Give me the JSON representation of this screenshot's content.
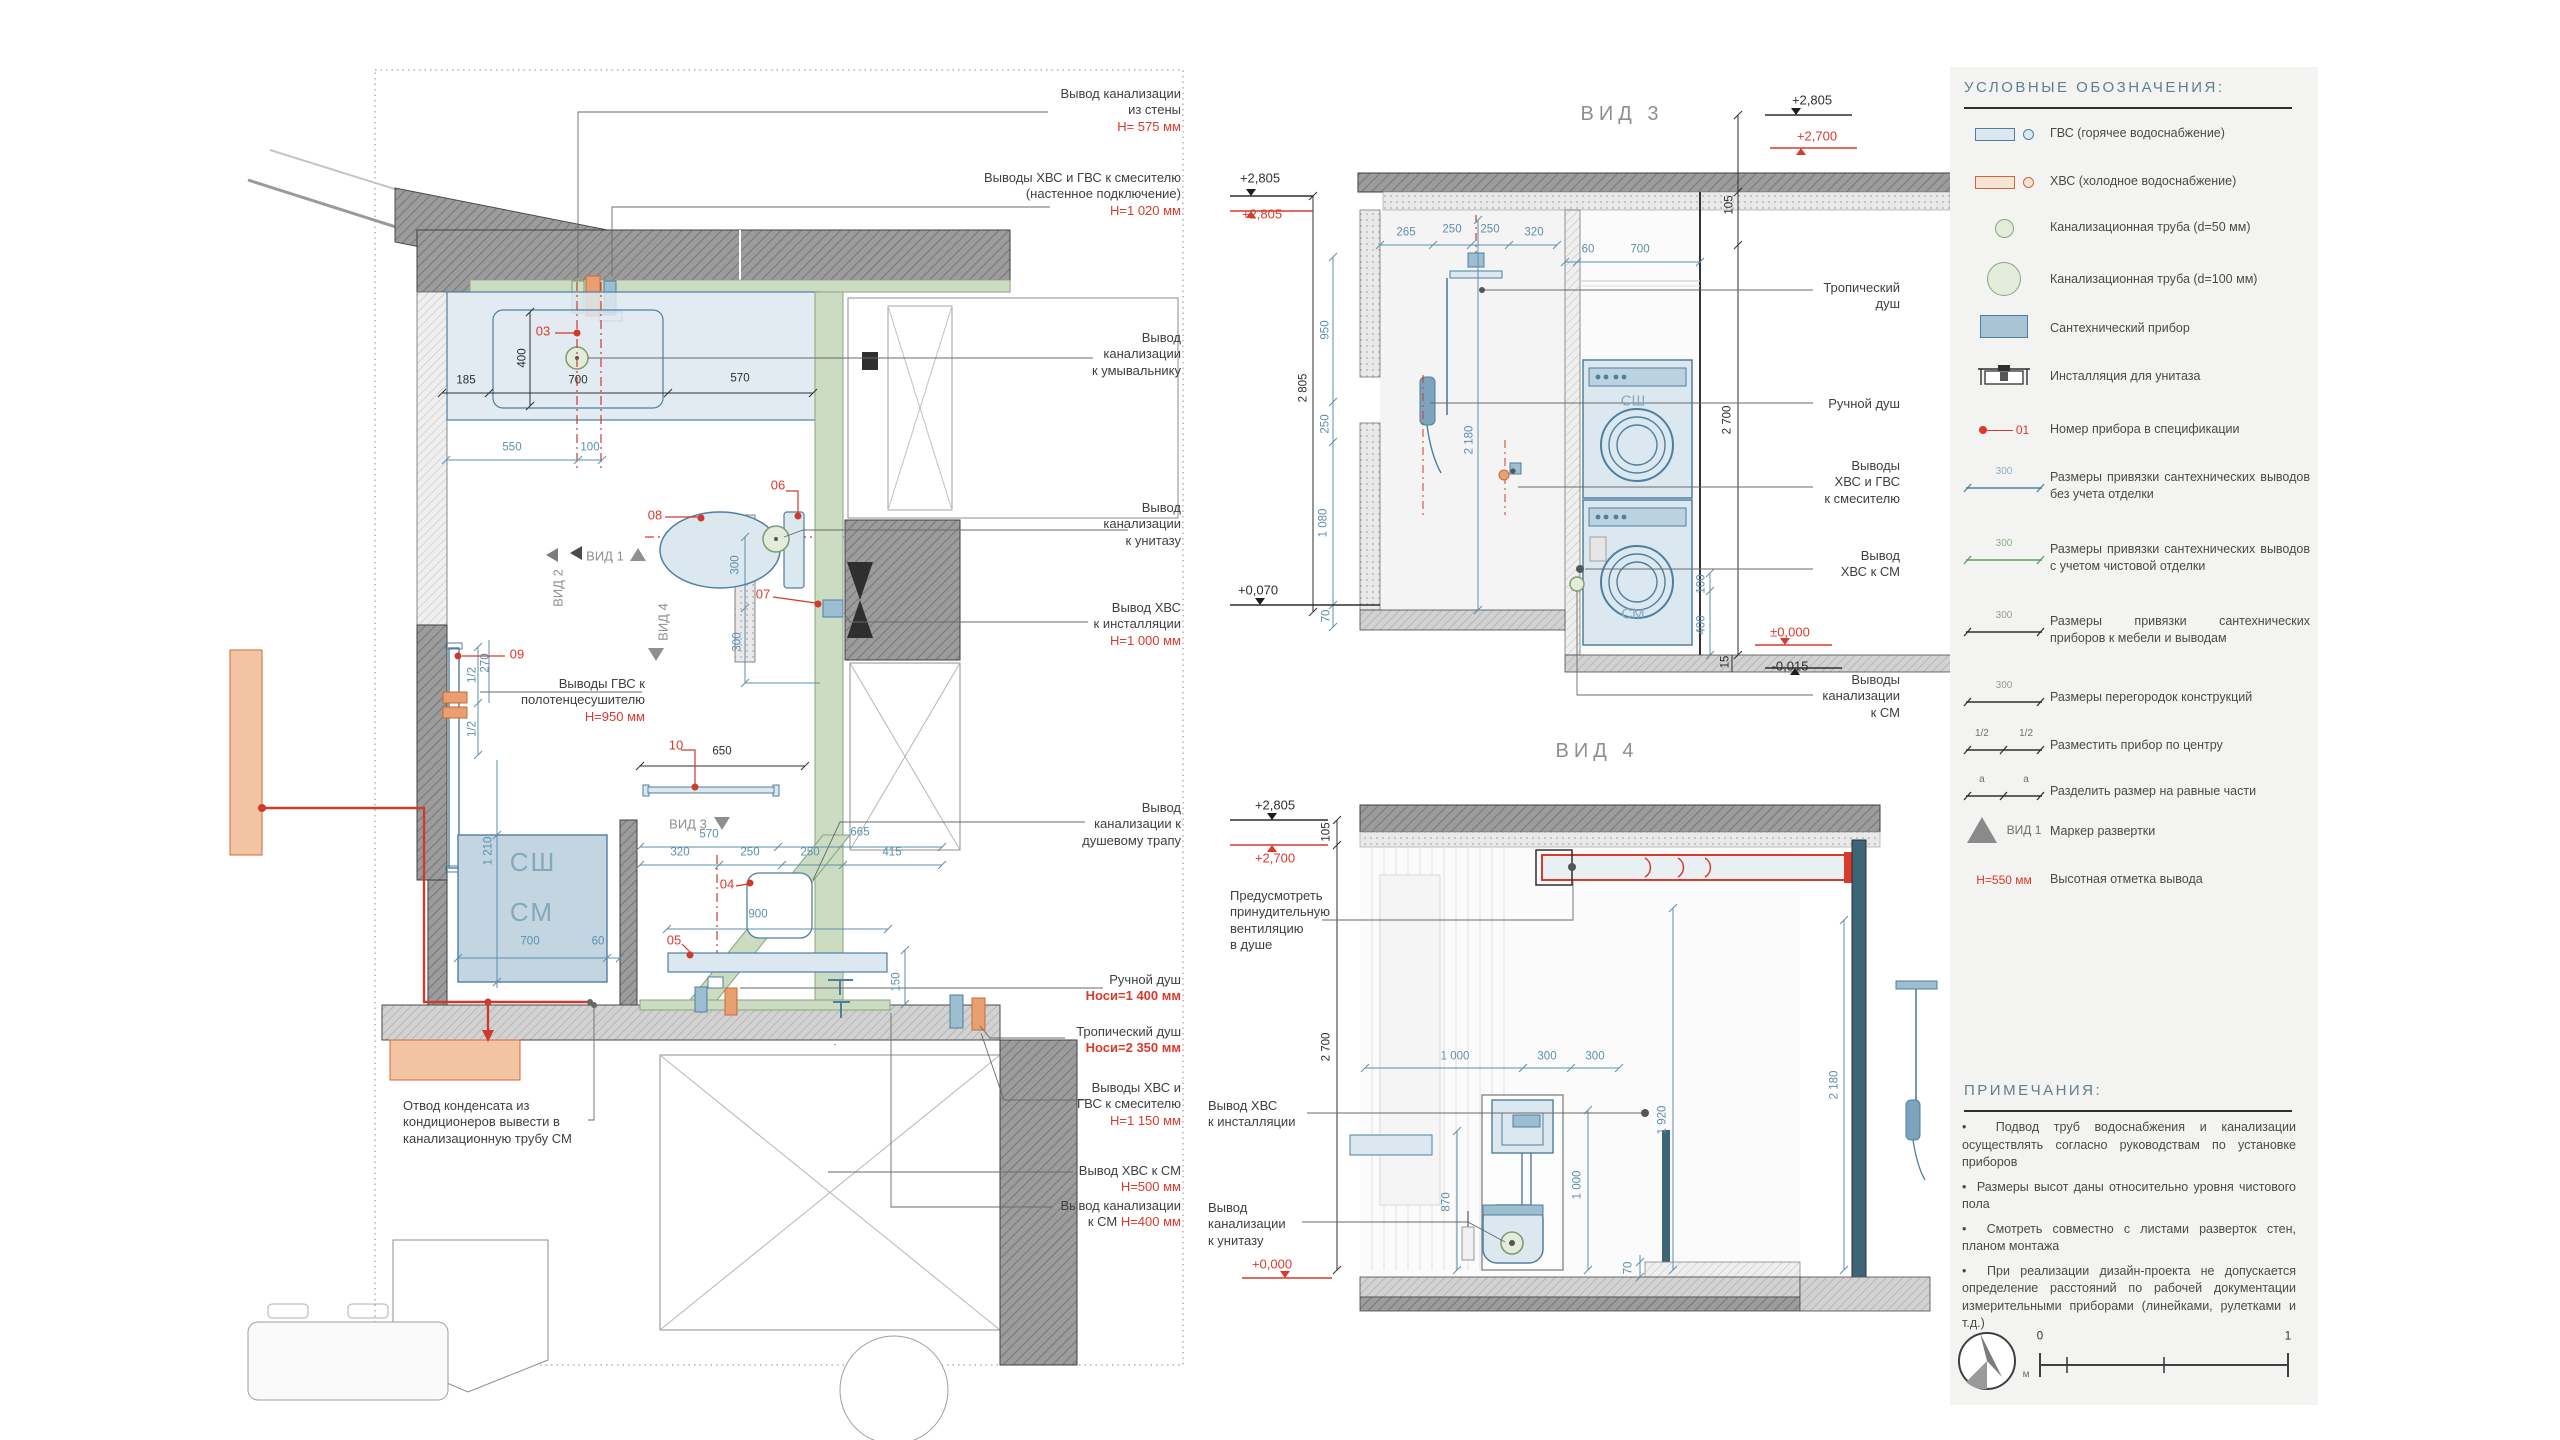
{
  "plan": {
    "view_markers": {
      "vid1": "ВИД 1",
      "vid2": "ВИД 2",
      "vid3": "ВИД 3",
      "vid4": "ВИД 4"
    },
    "labels": {
      "ssh": "СШ",
      "sm": "СМ"
    },
    "markers": {
      "m03": "03",
      "m04": "04",
      "m05": "05",
      "m06": "06",
      "m07": "07",
      "m08": "08",
      "m09": "09",
      "m10": "10"
    },
    "dims": {
      "d185": "185",
      "d700": "700",
      "d570": "570",
      "d400": "400",
      "d550": "550",
      "d100": "100",
      "d650": "650",
      "d300a": "300",
      "d300b": "300",
      "d570s": "570",
      "d665": "665",
      "d320": "320",
      "d250a": "250",
      "d250b": "250",
      "d415": "415",
      "d900": "900",
      "d150": "150",
      "d1210": "1 210",
      "d700c": "700",
      "d60": "60",
      "d270": "270",
      "dh1": "1/2",
      "dh2": "1/2"
    },
    "callouts": [
      {
        "text": "Вывод канализации\nиз стены",
        "h": "H= 575 мм"
      },
      {
        "text": "Выводы ХВС и ГВС к смесителю\n(настенное подключение)",
        "h": "H=1 020 мм"
      },
      {
        "text": "Вывод\nканализации\nк умывальнику",
        "h": ""
      },
      {
        "text": "Вывод\nканализации\nк унитазу",
        "h": ""
      },
      {
        "text": "Вывод ХВС\nк инсталляции",
        "h": "H=1 000 мм"
      },
      {
        "text": "Вывод\nканализации к\nдушевому трапу",
        "h": ""
      },
      {
        "text": "Ручной душ",
        "h": "Hоси=1 400 мм"
      },
      {
        "text": "Тропический душ",
        "h": "Hоси=2 350 мм"
      },
      {
        "text": "Выводы ХВС и\nГВС к смесителю",
        "h": "H=1 150 мм"
      },
      {
        "text": "Вывод ХВС к СМ",
        "h": "H=500 мм"
      },
      {
        "text": "Вывод канализации\nк СМ ",
        "h": "H=400 мм"
      }
    ],
    "towel_callout": {
      "text": "Выводы ГВС к\nполотенцесушителю",
      "h": "H=950 мм"
    },
    "condensate_note": "Отвод конденсата из\nкондиционеров вывести в\nканализационную трубу СМ"
  },
  "view3": {
    "title": "ВИД 3",
    "levels": {
      "top_left": "+2,805",
      "top_left_red": "+2,805",
      "bottom_left": "+0,070",
      "top_right": "+2,805",
      "top_right_red": "+2,700",
      "zero": "±0,000",
      "minus": "-0,015"
    },
    "dims": {
      "d265": "265",
      "d250a": "250",
      "d250b": "250",
      "d320": "320",
      "d950": "950",
      "d250c": "250",
      "d1080": "1 080",
      "d70": "70",
      "d2805": "2 805",
      "d2180": "2 180",
      "d105": "105",
      "d60": "60",
      "d700": "700",
      "d2700": "2 700",
      "d100": "100",
      "d400": "400",
      "d15": "15"
    },
    "labels": {
      "ssh": "СШ",
      "sm": "СМ"
    },
    "callouts": [
      "Тропический\nдуш",
      "Ручной душ",
      "Выводы\nХВС и ГВС\nк смесителю",
      "Вывод\nХВС к СМ",
      "Выводы\nканализации\nк СМ"
    ]
  },
  "view4": {
    "title": "ВИД 4",
    "levels": {
      "top": "+2,805",
      "top_red": "+2,700",
      "zero_red": "+0,000"
    },
    "dims": {
      "d105": "105",
      "d2700": "2 700",
      "d1000": "1 000",
      "d300a": "300",
      "d300b": "300",
      "d1920": "1 920",
      "d1000v": "1 000",
      "d870": "870",
      "d70": "70",
      "d2180": "2 180"
    },
    "callouts": {
      "vent": "Предусмотреть\nпринудительную\nвентиляцию\nв душе",
      "hvs": "Вывод ХВС\nк инсталляции",
      "kanaliz": "Вывод\nканализации\nк унитазу"
    }
  },
  "legend": {
    "title": "УСЛОВНЫЕ ОБОЗНАЧЕНИЯ:",
    "items": [
      {
        "icon": "gvs-icon",
        "label": "ГВС (горячее водоснабжение)"
      },
      {
        "icon": "hvs-icon",
        "label": "ХВС (холодное водоснабжение)"
      },
      {
        "icon": "pipe50-icon",
        "label": "Канализационная труба (d=50 мм)"
      },
      {
        "icon": "pipe100-icon",
        "label": "Канализационная труба (d=100 мм)"
      },
      {
        "icon": "fixture-icon",
        "label": "Сантехнический прибор"
      },
      {
        "icon": "installation-icon",
        "label": "Инсталляция для унитаза"
      },
      {
        "icon": "number-icon",
        "label": "Номер прибора в спецификации",
        "tag": "01"
      },
      {
        "icon": "dim-blue-icon",
        "label": "Размеры привязки сантехнических выводов без учета отделки",
        "tag": "300"
      },
      {
        "icon": "dim-green-icon",
        "label": "Размеры привязки сантехнических выводов с учетом чистовой отделки",
        "tag": "300"
      },
      {
        "icon": "dim-black-icon",
        "label": "Размеры привязки сантехнических приборов к мебели и выводам",
        "tag": "300"
      },
      {
        "icon": "dim-black-icon",
        "label": "Размеры перегородок конструкций",
        "tag": "300"
      },
      {
        "icon": "dim-center-icon",
        "label": "Разместить прибор по центру",
        "tag": "1/2",
        "tag2": "1/2"
      },
      {
        "icon": "dim-equal-icon",
        "label": "Разделить размер на равные части",
        "tag": "a",
        "tag2": "a"
      },
      {
        "icon": "view-marker-icon",
        "label": "Маркер развертки",
        "tag": "ВИД 1"
      },
      {
        "icon": "height-mark-icon",
        "label": "Высотная отметка вывода",
        "tag": "H=550 мм"
      }
    ]
  },
  "notes": {
    "title": "ПРИМЕЧАНИЯ:",
    "items": [
      "Подвод труб водоснабжения и канализации осуществлять согласно руководствам по установке приборов",
      "Размеры высот даны относительно уровня чистового пола",
      "Смотреть совместно с листами разверток стен, планом монтажа",
      "При реализации дизайн-проекта не допускается определение расстояний по рабочей документации измерительными приборами (линейками, рулетками и т.д.)"
    ],
    "scale": {
      "zero": "0",
      "one": "1",
      "unit": "м"
    }
  }
}
